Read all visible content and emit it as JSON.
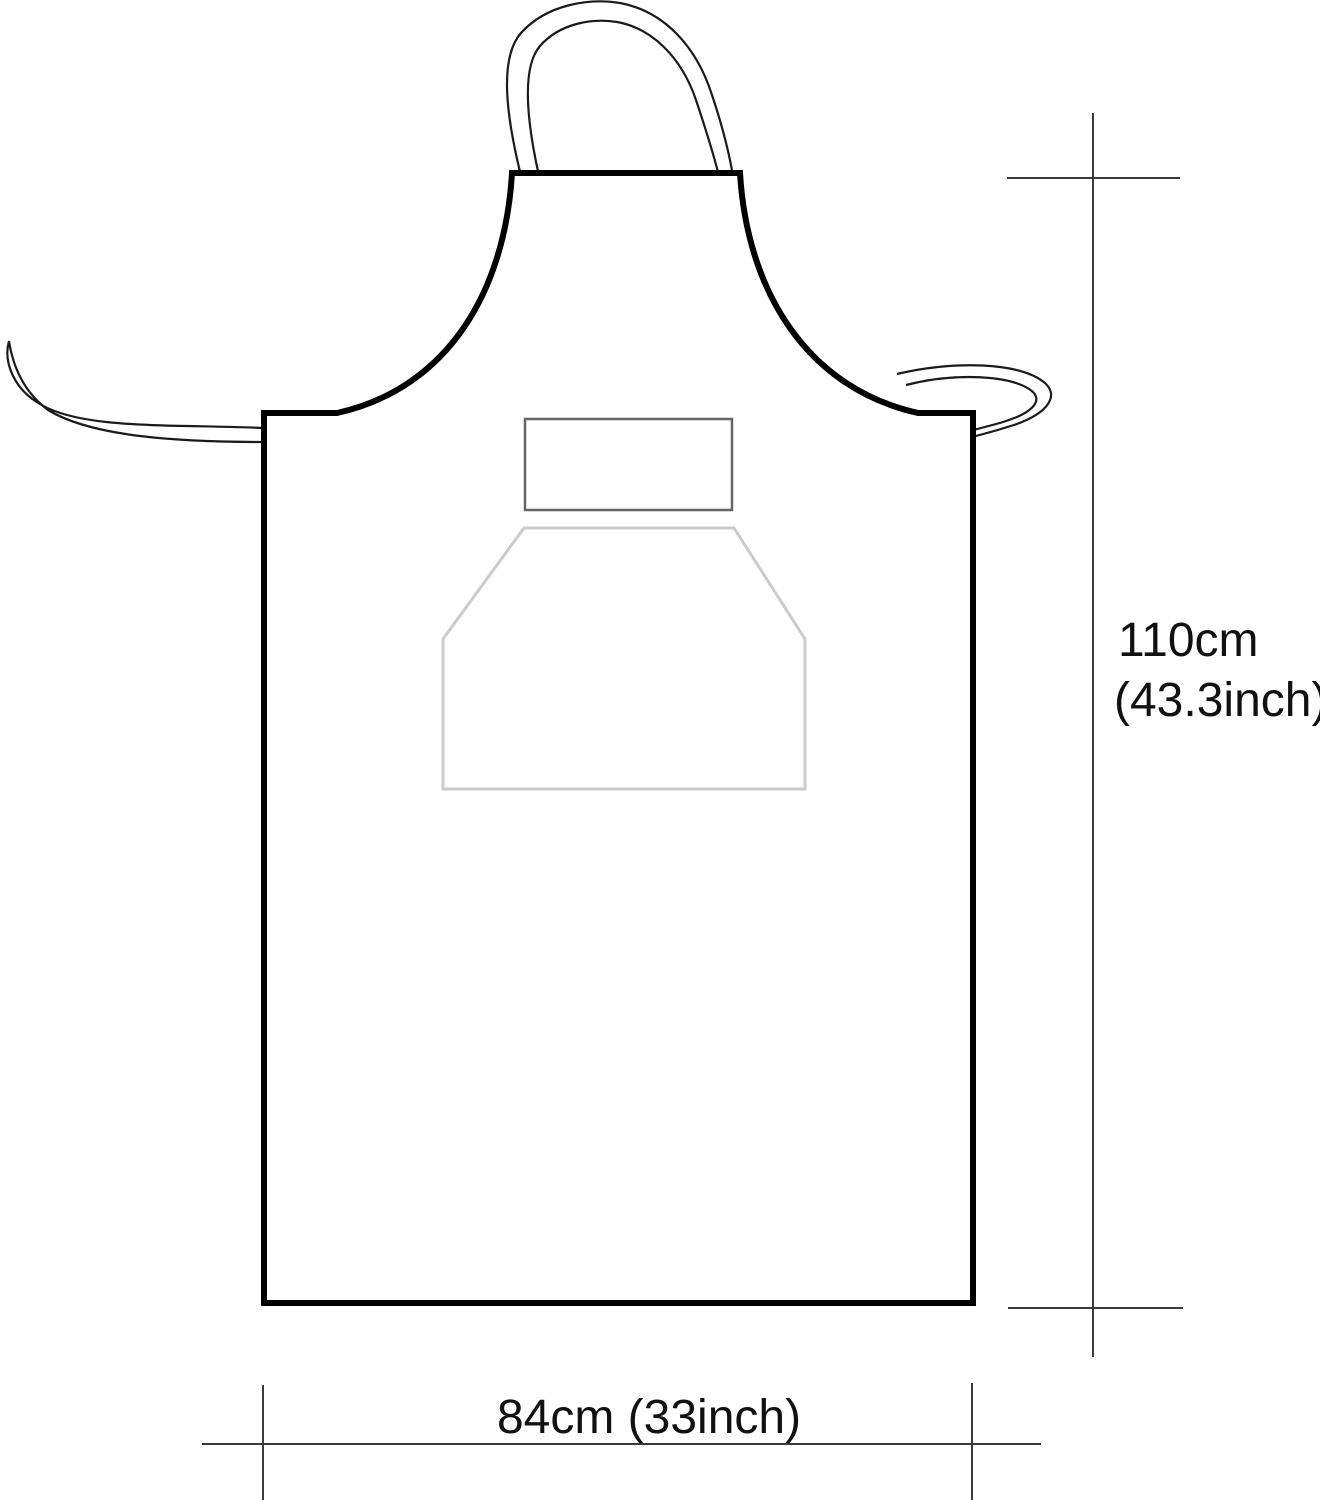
{
  "diagram": {
    "type": "product-dimension-diagram",
    "subject": "apron outline drawing with neck strap, waist ties, chest label and front pocket",
    "height_dimension": {
      "line1": "110cm",
      "line2": "(43.3inch)",
      "orientation": "vertical",
      "measures": "apron length from bib top to hem"
    },
    "width_dimension": {
      "label": "84cm (33inch)",
      "orientation": "horizontal",
      "measures": "apron width at hem"
    }
  },
  "colors": {
    "background": "#ffffff",
    "outline": "#000000",
    "strap": "#1a1a1a",
    "dimension_line": "#3b3b3b",
    "text": "#111111",
    "chest_label_stroke": "#666666",
    "pocket_stroke": "#c9ccc9"
  }
}
